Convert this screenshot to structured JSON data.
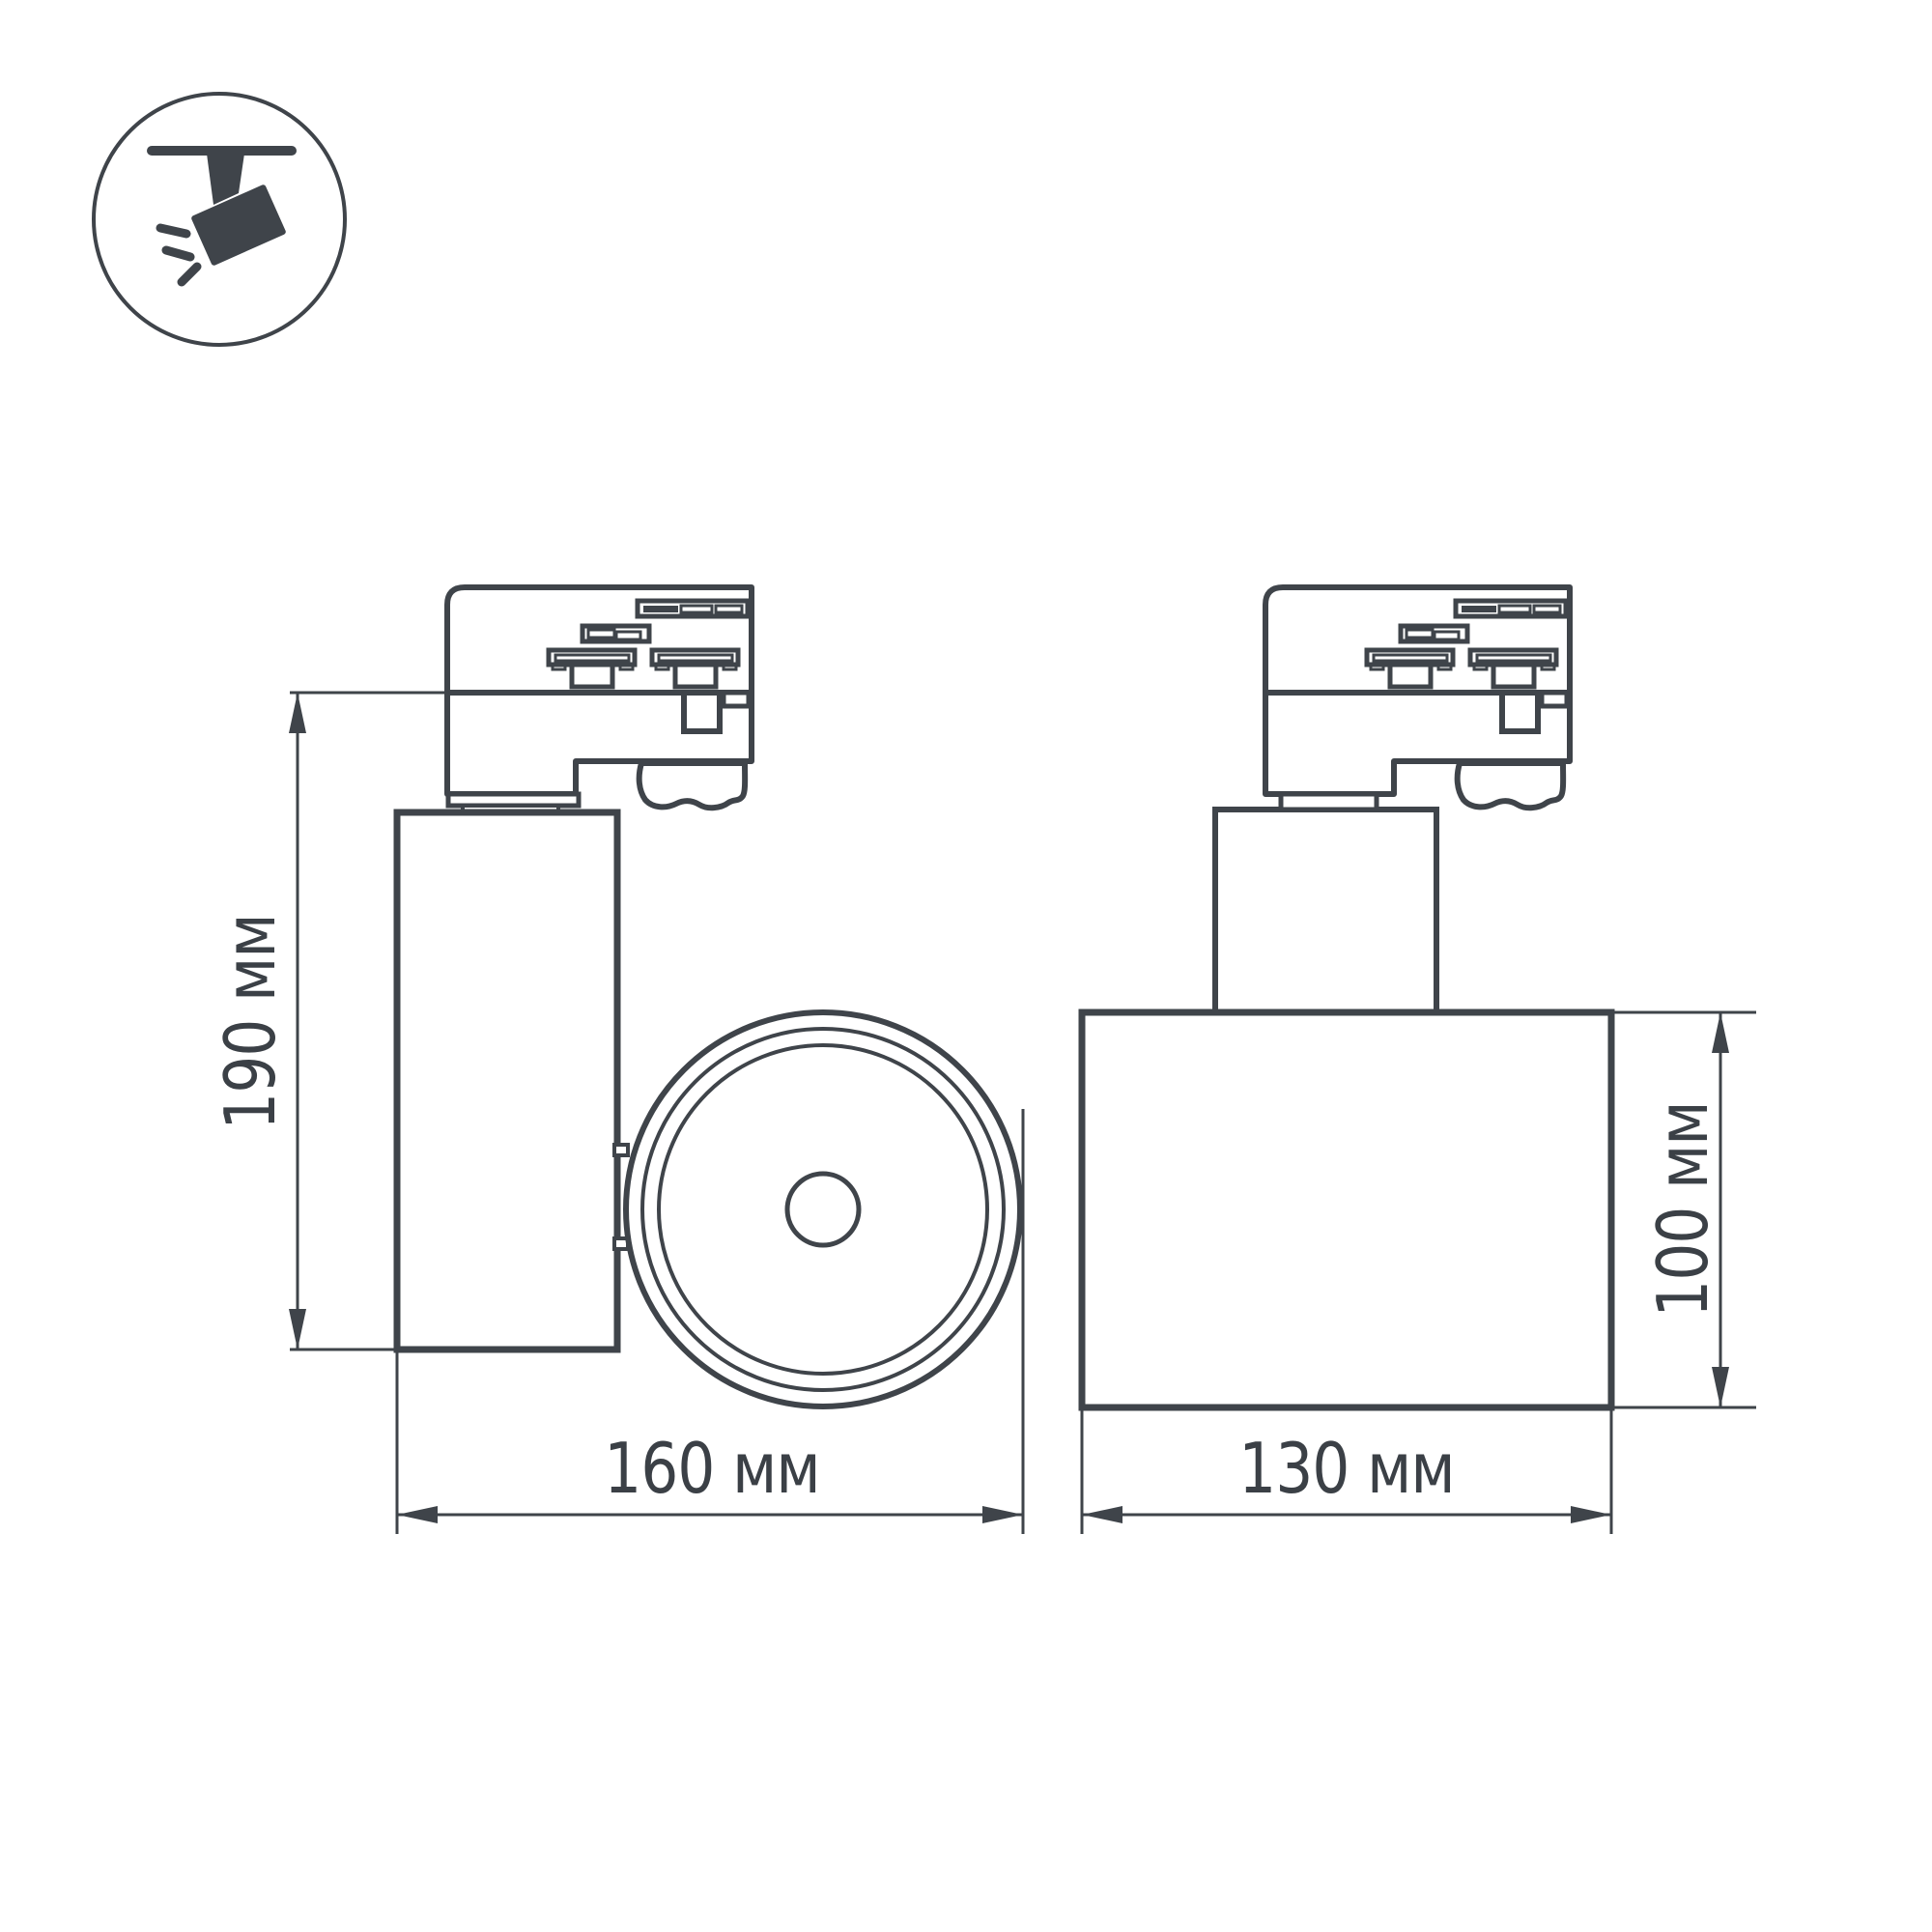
{
  "page": {
    "background": "#ffffff"
  },
  "drawing": {
    "stroke_color": "#3f444a",
    "text_color": "#3b4046",
    "icon": {
      "name": "track-spotlight-icon"
    },
    "dimensions": {
      "side_height": "190 мм",
      "side_width": "160 мм",
      "front_width": "130 мм",
      "front_height": "100 мм"
    }
  }
}
